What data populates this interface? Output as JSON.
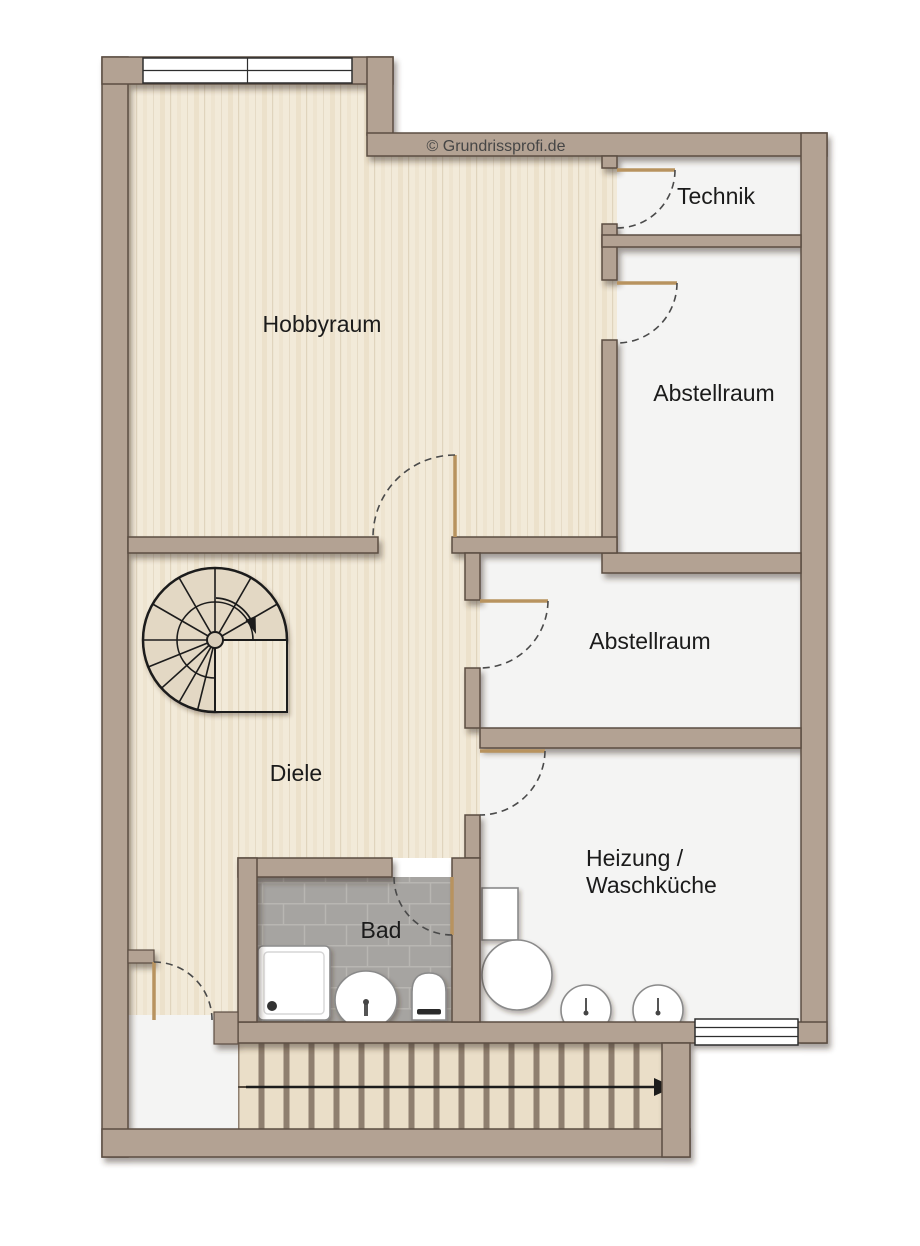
{
  "watermark": "© Grundrissprofi.de",
  "rooms": {
    "hobbyraum": {
      "label": "Hobbyraum"
    },
    "technik": {
      "label": "Technik"
    },
    "abstellraum_top": {
      "label": "Abstellraum"
    },
    "abstellraum_mid": {
      "label": "Abstellraum"
    },
    "diele": {
      "label": "Diele"
    },
    "bad": {
      "label": "Bad"
    },
    "heizung_waschkueche": {
      "line1": "Heizung /",
      "line2": "Waschküche"
    }
  },
  "colors": {
    "background": "#ffffff",
    "wall": "#b3a293",
    "wall_outline": "#5b4e42",
    "wood_floor": "#f2ead9",
    "light_floor": "#f4f4f3",
    "tile_floor": "#a6a4a1",
    "tile_grout": "#b8b6b2",
    "stair_tread": "#eadec8",
    "stair_gap": "#8f7f6f",
    "door_leaf": "#b8935f",
    "swing_arc": "#4a4a4a",
    "line": "#1c1c1c",
    "fixture_fill": "#ffffff",
    "fixture_stroke": "#8a8a8a",
    "label_text": "#1b1b1b",
    "watermark_text": "#464646"
  },
  "fixtures": {
    "bad": [
      "shower-tray",
      "washbasin",
      "toilet"
    ],
    "heizung": [
      "washing-machine",
      "boiler",
      "laundry-sink",
      "laundry-sink"
    ]
  },
  "stairs": [
    "spiral-staircase",
    "straight-staircase",
    "stairs-direction-arrow"
  ],
  "windows": [
    "window-north",
    "window-south"
  ],
  "doors": [
    "technik-door",
    "abstellraum-top-door",
    "hobbyraum-door",
    "abstellraum-mid-door",
    "heizung-door",
    "bad-door",
    "cellar-exit-door"
  ]
}
